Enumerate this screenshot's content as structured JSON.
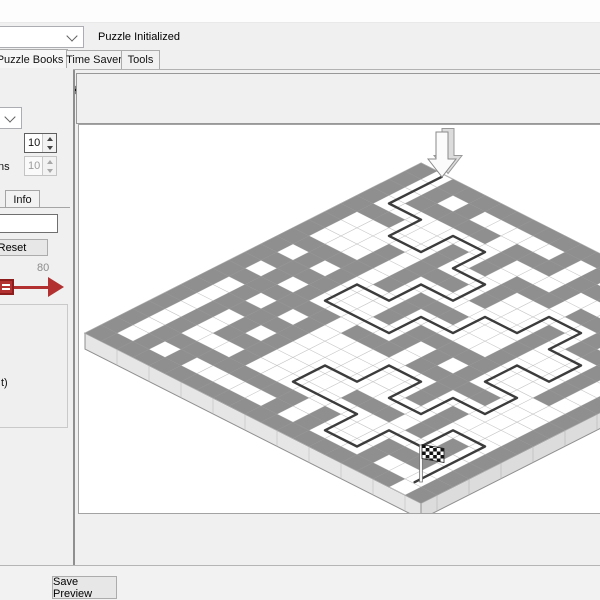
{
  "header": {
    "status": "Puzzle Initialized",
    "combo_value": ""
  },
  "tabs": [
    {
      "label": "t Puzzle Books"
    },
    {
      "label": "Time Saver"
    },
    {
      "label": "Tools"
    }
  ],
  "toolbar": {
    "open_icon": "open-folder",
    "save_icon": "save-floppy",
    "save_as_icon": "save-floppy-plus"
  },
  "left_panel": {
    "combo_value": "",
    "rows_value": "10",
    "columns_label_end": "ns",
    "columns_value": "10",
    "info_tab": "Info",
    "text_value": "",
    "reset": "Reset",
    "slider_value": "80",
    "slider_color": "#b23030",
    "group_text_end": "t)"
  },
  "bottom": {
    "save_preview": "Save Preview"
  },
  "maze": {
    "grid_rows": 10,
    "grid_cols": 10,
    "fine": 21,
    "origin_x": 342,
    "origin_y": 38,
    "half_w": 16,
    "half_h": 8.1,
    "thickness": 16,
    "seed": 1337,
    "wall_prob": 0.52,
    "colors": {
      "floor": "#ffffff",
      "grid_line": "#c6c6c6",
      "wall": "#8f8f8f",
      "plate_side": "#e6e6e6",
      "plate_side2": "#dcdcdc",
      "outline": "#8f8f8f",
      "path": "#3c3c3c"
    },
    "entrance_tile": [
      1,
      0
    ],
    "exit_tile": [
      19,
      20
    ],
    "path_cells": [
      [
        0,
        0
      ],
      [
        0,
        1
      ],
      [
        1,
        1
      ],
      [
        1,
        2
      ],
      [
        2,
        2
      ],
      [
        2,
        1
      ],
      [
        3,
        1
      ],
      [
        3,
        2
      ],
      [
        4,
        2
      ],
      [
        4,
        3
      ],
      [
        3,
        3
      ],
      [
        3,
        4
      ],
      [
        2,
        4
      ],
      [
        2,
        5
      ],
      [
        3,
        5
      ],
      [
        4,
        5
      ],
      [
        4,
        4
      ],
      [
        5,
        4
      ],
      [
        5,
        3
      ],
      [
        6,
        3
      ],
      [
        6,
        2
      ],
      [
        7,
        2
      ],
      [
        7,
        3
      ],
      [
        8,
        3
      ],
      [
        8,
        4
      ],
      [
        7,
        4
      ],
      [
        7,
        5
      ],
      [
        8,
        5
      ],
      [
        8,
        6
      ],
      [
        7,
        6
      ],
      [
        7,
        7
      ],
      [
        6,
        7
      ],
      [
        6,
        6
      ],
      [
        5,
        6
      ],
      [
        5,
        7
      ],
      [
        4,
        7
      ],
      [
        4,
        8
      ],
      [
        5,
        8
      ],
      [
        6,
        8
      ],
      [
        6,
        9
      ],
      [
        7,
        9
      ],
      [
        7,
        8
      ],
      [
        8,
        8
      ],
      [
        8,
        7
      ],
      [
        9,
        7
      ],
      [
        9,
        8
      ],
      [
        9,
        9
      ]
    ]
  }
}
